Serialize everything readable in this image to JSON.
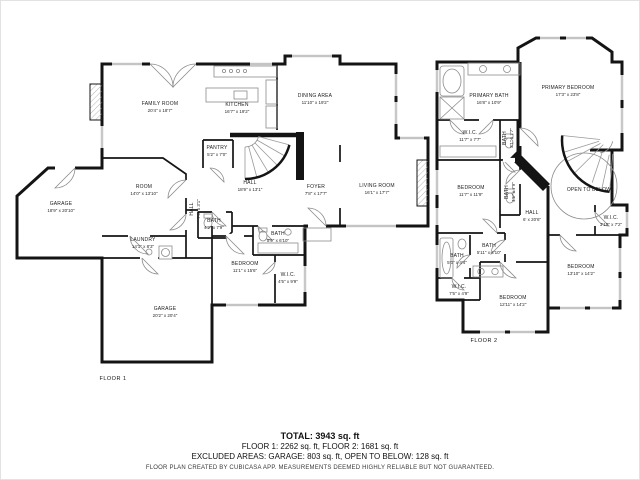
{
  "colors": {
    "wall": "#141414",
    "fixture": "#8c8c8c",
    "window": "#9a9a9a",
    "background": "#ffffff"
  },
  "floor1": {
    "caption": "FLOOR 1",
    "rooms": [
      {
        "name": "FAMILY ROOM",
        "dims": "20'4\" x 18'7\""
      },
      {
        "name": "KITCHEN",
        "dims": "16'7\" x 19'2\""
      },
      {
        "name": "DINING AREA",
        "dims": "11'10\" x 19'2\""
      },
      {
        "name": "PANTRY",
        "dims": "5'2\" x 7'0\""
      },
      {
        "name": "HALL",
        "dims": "18'9\" x 13'1\""
      },
      {
        "name": "FOYER",
        "dims": "7'8\" x 17'7\""
      },
      {
        "name": "LIVING ROOM",
        "dims": "16'1\" x 17'7\""
      },
      {
        "name": "GARAGE",
        "dims": "18'9\" x 20'10\""
      },
      {
        "name": "ROOM",
        "dims": "14'0\" x 13'10\""
      },
      {
        "name": "LAUNDRY",
        "dims": "14'1\" x 8'3\""
      },
      {
        "name": "BATH",
        "dims": "4'2\" x 7'9\""
      },
      {
        "name": "BATH",
        "dims": "5'9\" x 6'10\""
      },
      {
        "name": "BEDROOM",
        "dims": "11'1\" x 15'6\""
      },
      {
        "name": "W.I.C.",
        "dims": "4'5\" x 9'9\""
      },
      {
        "name": "GARAGE",
        "dims": "20'2\" x 20'4\""
      },
      {
        "name": "HALL",
        "dims": "7'8\" x 3'1\""
      }
    ]
  },
  "floor2": {
    "caption": "FLOOR 2",
    "rooms": [
      {
        "name": "PRIMARY BATH",
        "dims": "16'8\" x 10'9\""
      },
      {
        "name": "PRIMARY BEDROOM",
        "dims": "17'3\" x 23'8\""
      },
      {
        "name": "W.I.C.",
        "dims": "11'7\" x 7'7\""
      },
      {
        "name": "BATH",
        "dims": "3'1\" x 7'7\""
      },
      {
        "name": "BEDROOM",
        "dims": "11'7\" x 11'9\""
      },
      {
        "name": "BATH",
        "dims": "4'5\" x 7'9\""
      },
      {
        "name": "OPEN TO BELOW",
        "dims": ""
      },
      {
        "name": "HALL",
        "dims": "6' x 20'6\""
      },
      {
        "name": "W.I.C.",
        "dims": "3'10\" x 7'2\""
      },
      {
        "name": "BATH",
        "dims": "5'0\" x 4'4\""
      },
      {
        "name": "BATH",
        "dims": "5'11\" x 4'10\""
      },
      {
        "name": "W.I.C.",
        "dims": "7'5\" x 4'9\""
      },
      {
        "name": "BEDROOM",
        "dims": "12'11\" x 14'2\""
      },
      {
        "name": "BEDROOM",
        "dims": "13'10\" x 14'2\""
      }
    ]
  },
  "footer": {
    "total": "TOTAL: 3943 sq. ft",
    "floors_line": "FLOOR 1: 2262 sq. ft, FLOOR 2: 1681 sq. ft",
    "excluded_line": "EXCLUDED AREAS: GARAGE: 803 sq. ft, OPEN TO BELOW: 128 sq. ft",
    "disclaimer": "FLOOR PLAN CREATED BY CUBICASA APP. MEASUREMENTS DEEMED HIGHLY RELIABLE BUT NOT GUARANTEED."
  }
}
